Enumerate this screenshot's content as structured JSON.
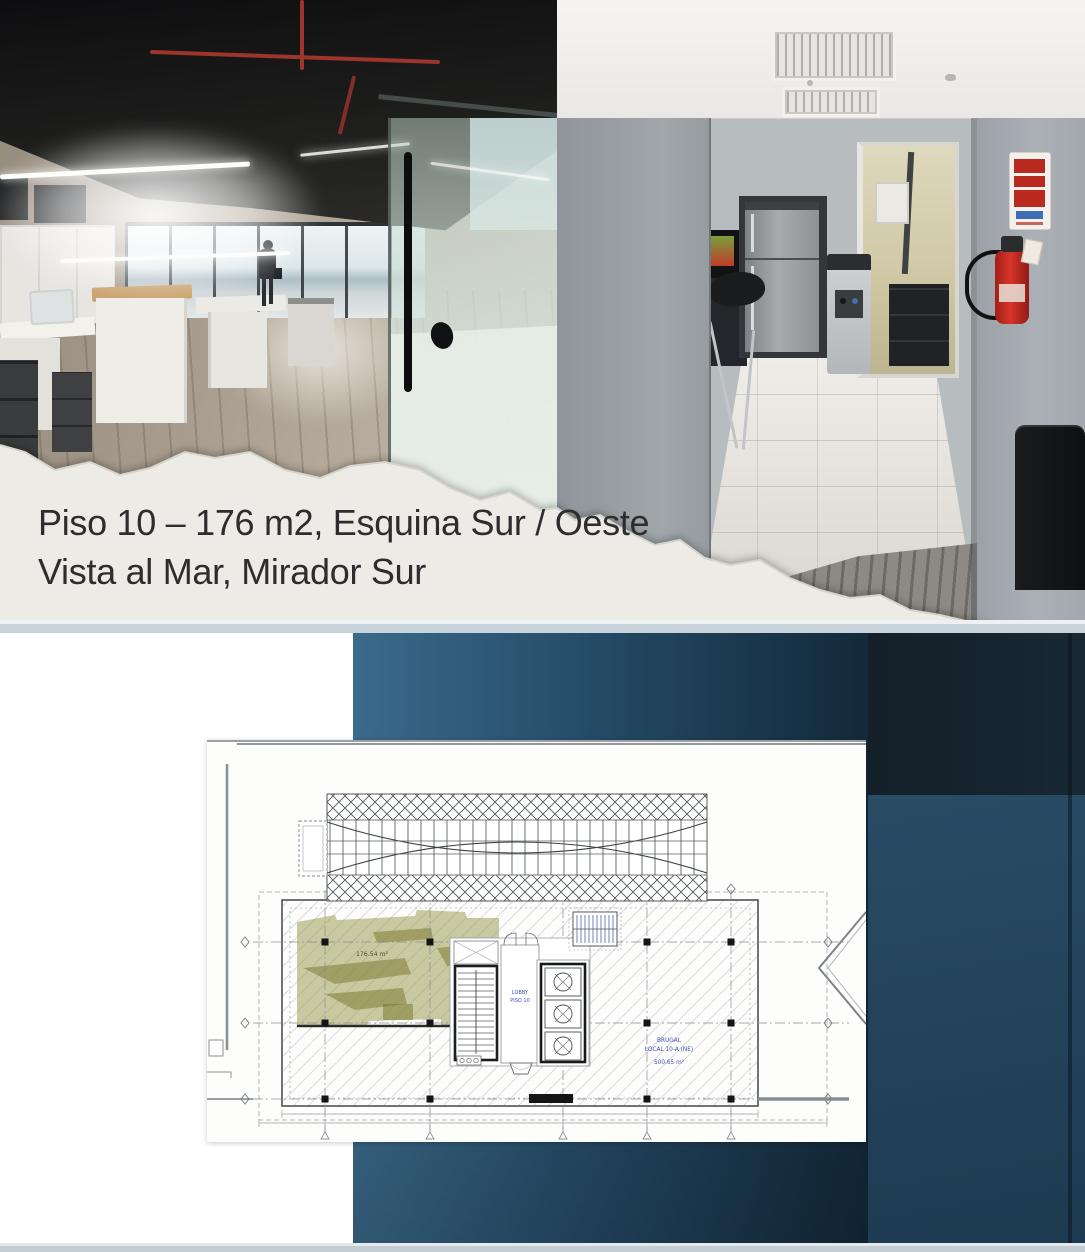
{
  "slide": {
    "caption": {
      "line1": "Piso 10 – 176 m2, Esquina Sur / Oeste",
      "line2": "Vista al Mar, Mirador Sur"
    }
  },
  "floorplan": {
    "highlight_area": "176.54 m²",
    "lobby_line1": "LOBBY",
    "lobby_line2": "PISO 10",
    "tenant_line1": "BRUGAL",
    "tenant_line2": "LOCAL 10-A (NE)",
    "tenant_line3": "500.65 m²"
  },
  "colors": {
    "accent_teal": "#254c68",
    "dark_navy": "#15222c",
    "slate_blue": "#2c4f68",
    "highlight_olive": "#969646",
    "plan_label_blue": "#3b4cc0",
    "paper": "#edebe6"
  }
}
